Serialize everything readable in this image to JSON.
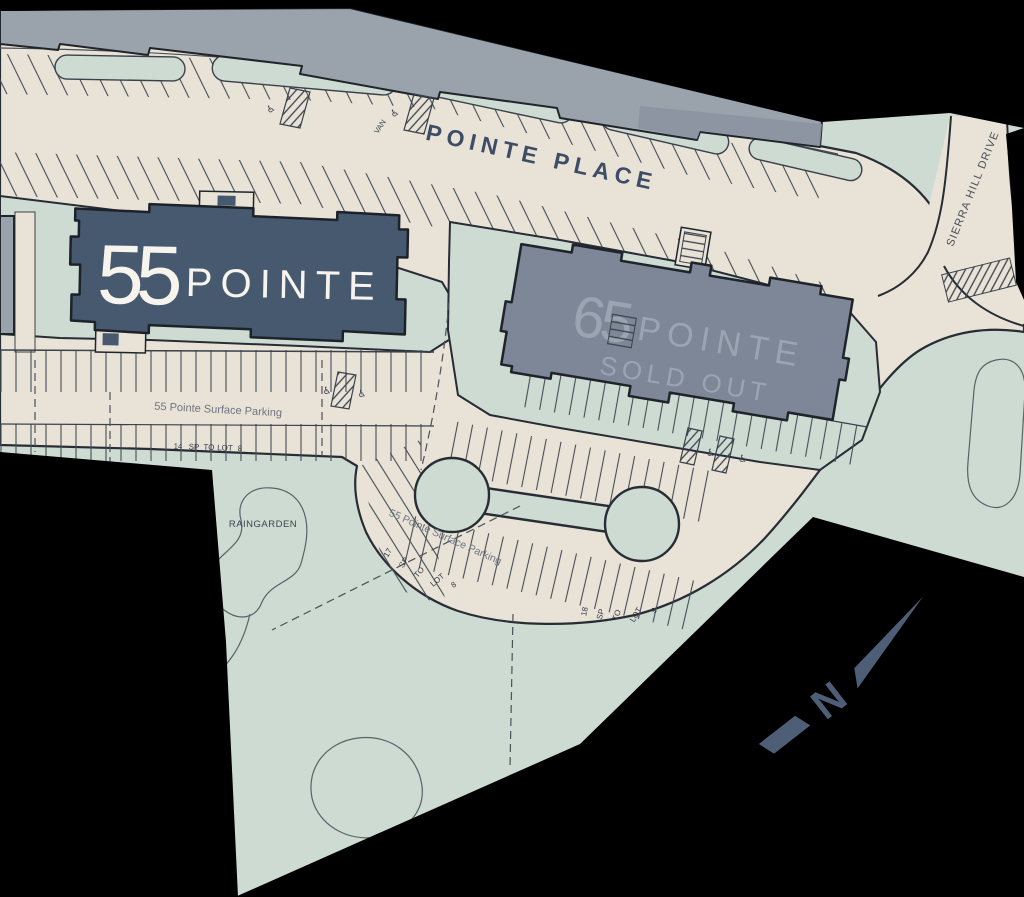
{
  "title": "55 Pointe / 65 Pointe site plan",
  "streets": {
    "pointe_place": "POINTE PLACE",
    "sierra_hill_drive": "SIERRA HILL DRIVE"
  },
  "buildings": {
    "b55": {
      "number": "55",
      "name": "POINTE"
    },
    "b65": {
      "number": "65",
      "name": "POINTE",
      "status": "SOLD OUT"
    }
  },
  "labels": {
    "surface_parking_row": "55 Pointe Surface Parking",
    "surface_parking_loop": "55 Pointe Surface Parking",
    "raingarden": "RAINGARDEN",
    "van": "VAN",
    "north": "N"
  },
  "icons": {
    "accessible": "♿"
  },
  "parking_tallies": {
    "row55": [
      "14",
      "SP",
      "TO",
      "LOT",
      "8"
    ],
    "loop_west": [
      "17",
      "SP",
      "TO",
      "LOT",
      "8"
    ],
    "loop_south": [
      "18",
      "SP",
      "TO",
      "LOT",
      "9"
    ]
  },
  "colors": {
    "background": "#000000",
    "pavement": "#e9e3d7",
    "landscape": "#cddbd2",
    "building_top": "#9aa2ac",
    "building_55": "#47596e",
    "building_55_text": "#f6f4ed",
    "building_65": "#7d8797",
    "building_65_text": "#9aa4b2",
    "line_dark": "#20252c",
    "street_text": "#3d4d66",
    "muted_text": "#6d7480",
    "north_arrow": "#4e5e76"
  }
}
